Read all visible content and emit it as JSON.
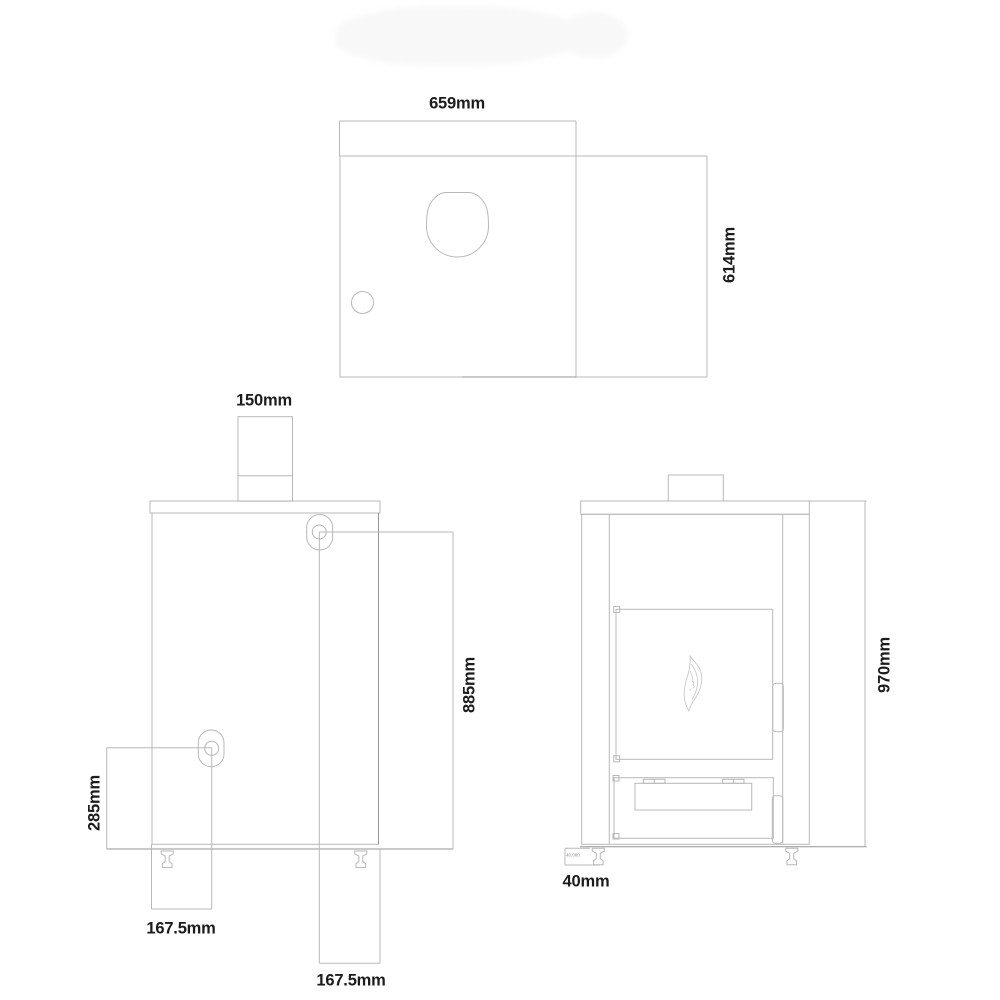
{
  "colors": {
    "background": "#ffffff",
    "line": "#b8b8b8",
    "line_dark": "#949494",
    "text": "#1c1c1c",
    "watermark": "#f8f8f8"
  },
  "icons": {
    "door_logo": "flame-icon"
  },
  "views": {
    "top": {
      "labels": {
        "width": "659mm",
        "depth": "614mm"
      }
    },
    "rear": {
      "labels": {
        "flue_diameter": "150mm",
        "flue_outlet_height": "885mm",
        "lower_outlet_height": "285mm",
        "lower_outlet_offset": "167.5mm",
        "upper_outlet_offset": "167.5mm"
      }
    },
    "front": {
      "labels": {
        "overall_height": "970mm",
        "foot_height": "40mm",
        "foot_height_detail": "40.000"
      }
    }
  }
}
